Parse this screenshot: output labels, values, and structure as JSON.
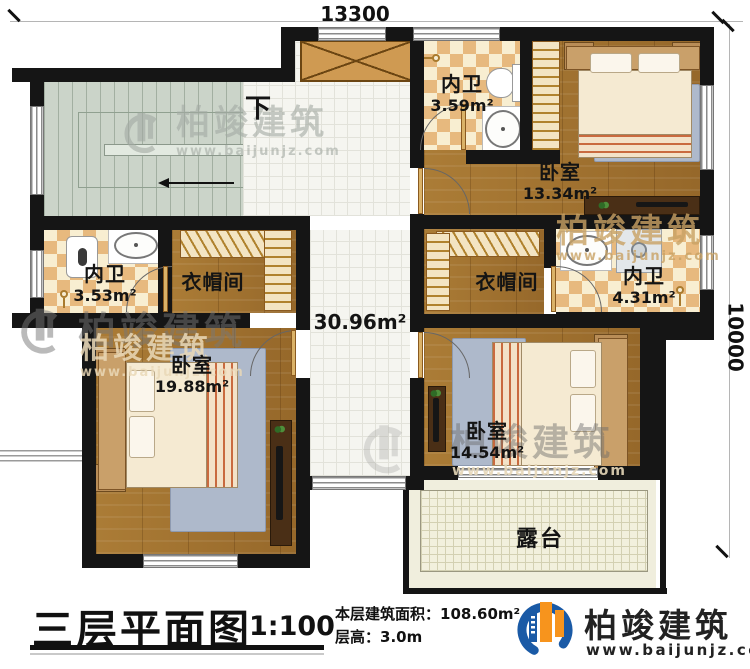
{
  "dimensions": {
    "width_mm": "13300",
    "depth_mm": "10000"
  },
  "stairs": {
    "direction_label": "下"
  },
  "rooms": {
    "hall": {
      "area": "30.96m²"
    },
    "bath_top_mid": {
      "name": "内卫",
      "area": "3.59m²"
    },
    "bedroom_top_right": {
      "name": "卧室",
      "area": "13.34m²"
    },
    "bath_left": {
      "name": "内卫",
      "area": "3.53m²"
    },
    "closet_left": {
      "name": "衣帽间"
    },
    "closet_right": {
      "name": "衣帽间"
    },
    "bath_right": {
      "name": "内卫",
      "area": "4.31m²"
    },
    "bedroom_bottom_left": {
      "name": "卧室",
      "area": "19.88m²"
    },
    "bedroom_bottom_right": {
      "name": "卧室",
      "area": "14.54m²"
    },
    "terrace": {
      "name": "露台"
    }
  },
  "title_block": {
    "title": "三层平面图",
    "scale": "1:100",
    "floor_area_label": "本层建筑面积：",
    "floor_area_value": "108.60m²",
    "floor_height_label": "层高：",
    "floor_height_value": "3.0m"
  },
  "brand": {
    "name": "柏竣建筑",
    "website": "www.baijunjz.com"
  },
  "watermark": {
    "name": "柏竣建筑",
    "website": "www.baijunjz.com"
  },
  "colors": {
    "wall": "#151515",
    "wood": "#a5762f",
    "tile_tan": "#e7b97e",
    "stair": "#cbd4c9",
    "brand_blue": "#1a5aa6",
    "brand_orange": "#f7941d"
  }
}
